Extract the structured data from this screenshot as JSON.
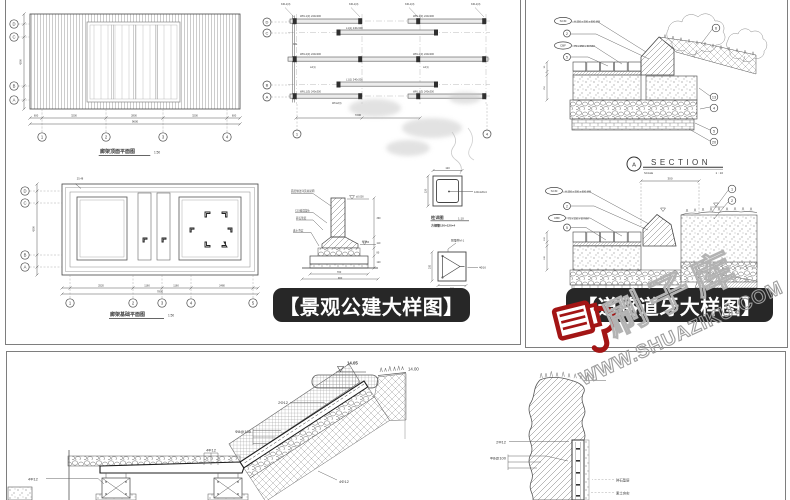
{
  "banners": {
    "landscape": "【景观公建大样图】",
    "road": "【道路道牙大样图】"
  },
  "watermark": {
    "brand": "刷子库",
    "domain": "WWW.SHUAZIKU.COM",
    "accent_color": "#a31515"
  },
  "landscape_panel": {
    "deck_plan": {
      "title": "廊架顶面平面图",
      "scale": "1:50",
      "row_bubbles": [
        {
          "x": 14,
          "y": 24,
          "t": "D"
        },
        {
          "x": 14,
          "y": 37,
          "t": "C"
        },
        {
          "x": 14,
          "y": 86,
          "t": "B"
        },
        {
          "x": 14,
          "y": 100,
          "t": "A"
        }
      ],
      "col_bubbles": [
        {
          "x": 42,
          "y": 137,
          "t": "1"
        },
        {
          "x": 106,
          "y": 137,
          "t": "2"
        },
        {
          "x": 163,
          "y": 137,
          "t": "3"
        },
        {
          "x": 227,
          "y": 137,
          "t": "4"
        }
      ],
      "dims": [
        {
          "x": 36,
          "y": 116.5,
          "t": "600",
          "s": 2.6,
          "a": "middle"
        },
        {
          "x": 74,
          "y": 116.5,
          "t": "3200",
          "s": 2.6,
          "a": "middle"
        },
        {
          "x": 134,
          "y": 116.5,
          "t": "2800",
          "s": 2.6,
          "a": "middle"
        },
        {
          "x": 195,
          "y": 116.5,
          "t": "3200",
          "s": 2.6,
          "a": "middle"
        },
        {
          "x": 234,
          "y": 116.5,
          "t": "600",
          "s": 2.6,
          "a": "middle"
        },
        {
          "x": 135,
          "y": 122.5,
          "t": "9600",
          "s": 2.8,
          "a": "middle"
        },
        {
          "x": 21.5,
          "y": 62,
          "t": "4200",
          "s": 2.6,
          "a": "middle",
          "r": -90
        }
      ]
    },
    "base_plan": {
      "title": "廊架基础平面图",
      "scale": "1:50",
      "row_bubbles": [
        {
          "x": 25,
          "y": 191,
          "t": "D"
        },
        {
          "x": 25,
          "y": 203,
          "t": "C"
        },
        {
          "x": 25,
          "y": 255,
          "t": "B"
        },
        {
          "x": 25,
          "y": 267,
          "t": "A"
        }
      ],
      "col_bubbles": [
        {
          "x": 70,
          "y": 303,
          "t": "1"
        },
        {
          "x": 133,
          "y": 303,
          "t": "2"
        },
        {
          "x": 162,
          "y": 303,
          "t": "3"
        },
        {
          "x": 191,
          "y": 303,
          "t": "4"
        },
        {
          "x": 253,
          "y": 303,
          "t": "5"
        }
      ],
      "dims": [
        {
          "x": 101,
          "y": 286.5,
          "t": "2520",
          "s": 2.6,
          "a": "middle"
        },
        {
          "x": 147,
          "y": 286.5,
          "t": "1160",
          "s": 2.6,
          "a": "middle"
        },
        {
          "x": 176,
          "y": 286.5,
          "t": "1160",
          "s": 2.6,
          "a": "middle"
        },
        {
          "x": 222,
          "y": 286.5,
          "t": "2480",
          "s": 2.6,
          "a": "middle"
        },
        {
          "x": 160,
          "y": 292.5,
          "t": "7800",
          "s": 2.8,
          "a": "middle"
        },
        {
          "x": 34.5,
          "y": 229,
          "t": "4200",
          "s": 2.6,
          "a": "middle",
          "r": -90
        },
        {
          "x": 80,
          "y": 179.5,
          "t": "25.48",
          "s": 2.6,
          "a": "middle"
        }
      ]
    },
    "framing_plan": {
      "row_bubbles": [
        {
          "x": 267,
          "y": 22,
          "t": "D",
          "r": 4
        },
        {
          "x": 267,
          "y": 33,
          "t": "C",
          "r": 4
        },
        {
          "x": 267,
          "y": 85,
          "t": "B",
          "r": 4
        },
        {
          "x": 267,
          "y": 97,
          "t": "A",
          "r": 4
        }
      ],
      "col_bubbles": [
        {
          "x": 297,
          "y": 134,
          "t": "1",
          "r": 4
        },
        {
          "x": 487,
          "y": 134,
          "t": "4",
          "r": 4
        }
      ],
      "top_labels": [
        {
          "x": 281,
          "y": 5,
          "t": "KZL1(3)",
          "s": 2.6
        },
        {
          "x": 349,
          "y": 5,
          "t": "KZL1(3)",
          "s": 2.6
        },
        {
          "x": 405,
          "y": 5,
          "t": "KZL1(3)",
          "s": 2.6
        },
        {
          "x": 471,
          "y": 5,
          "t": "KZL1(3)",
          "s": 2.6
        }
      ],
      "beam_labels": [
        {
          "x": 300,
          "y": 17,
          "t": "WKL1(3) 240x300",
          "s": 2.6
        },
        {
          "x": 413,
          "y": 17,
          "t": "WKL1(3) 240x300",
          "s": 2.6
        },
        {
          "x": 346,
          "y": 29,
          "t": "L1(1) 240x300",
          "s": 2.6
        },
        {
          "x": 293,
          "y": 45,
          "t": "KZ1",
          "s": 2.4
        },
        {
          "x": 300,
          "y": 55,
          "t": "WKL2(3) 240x300",
          "s": 2.6
        },
        {
          "x": 413,
          "y": 55,
          "t": "WKL2(3) 240x300",
          "s": 2.6
        },
        {
          "x": 310,
          "y": 68,
          "t": "L2(1)",
          "s": 2.4
        },
        {
          "x": 423,
          "y": 68,
          "t": "L2(1)",
          "s": 2.4
        },
        {
          "x": 346,
          "y": 80.5,
          "t": "L1(1) 240x300",
          "s": 2.6
        },
        {
          "x": 300,
          "y": 92.5,
          "t": "WKL1(3) 240x300",
          "s": 2.6
        },
        {
          "x": 413,
          "y": 92.5,
          "t": "WKL1(3) 240x300",
          "s": 2.6
        },
        {
          "x": 332,
          "y": 104,
          "t": "WKL2(3)",
          "s": 2.4
        }
      ],
      "dims": [
        {
          "x": 358,
          "y": 116,
          "t": "7200",
          "s": 2.8,
          "a": "middle"
        }
      ]
    },
    "footing_detail": {
      "notes": [
        {
          "x": 291,
          "y": 192,
          "t": "面层做法详见总说明",
          "s": 2.6
        },
        {
          "x": 295,
          "y": 211.5,
          "t": "C15素混凝土",
          "s": 2.6
        },
        {
          "x": 296,
          "y": 219,
          "t": "碎石垫层",
          "s": 2.6
        },
        {
          "x": 293,
          "y": 231.5,
          "t": "素土夯实",
          "s": 2.6
        }
      ],
      "dims": [
        {
          "x": 376.5,
          "y": 219,
          "t": "390",
          "s": 2.4
        },
        {
          "x": 376.5,
          "y": 244,
          "t": "110",
          "s": 2.4
        },
        {
          "x": 376.5,
          "y": 253.5,
          "t": "80",
          "s": 2.4
        },
        {
          "x": 376.5,
          "y": 263,
          "t": "120",
          "s": 2.4
        },
        {
          "x": 339,
          "y": 272.8,
          "t": "700",
          "s": 2.6,
          "a": "middle"
        },
        {
          "x": 340,
          "y": 278.8,
          "t": "900",
          "s": 2.6,
          "a": "middle"
        }
      ],
      "elevs": [
        {
          "x": 356,
          "y": 197.5,
          "t": "±0.000",
          "s": 2.5
        },
        {
          "x": 362,
          "y": 243,
          "t": "-0.450",
          "s": 2.5
        }
      ]
    },
    "tube_detail": {
      "title": "柱详图",
      "scale": "1:10",
      "subtitle": "方钢管120×120×4",
      "callout": "120x120x4",
      "dim_top": "120",
      "dim_left": "120"
    },
    "embed_detail": {
      "label_top": "预埋件M-1",
      "label_right": "4Φ16",
      "dim_left": "200",
      "dim_bottom": "280"
    }
  },
  "road_panel": {
    "section_a": {
      "callouts": [
        {
          "x": 563,
          "y": 21,
          "t": "SCM",
          "w": 8.5
        },
        {
          "x": 567,
          "y": 33.5,
          "t": "2",
          "r": 3.5
        },
        {
          "x": 563,
          "y": 45.5,
          "t": "CBF",
          "w": 8.5
        },
        {
          "x": 567,
          "y": 57,
          "t": "5",
          "r": 3.5
        }
      ],
      "notes": [
        {
          "x": 574,
          "y": 22.3,
          "t": "H 250 x 300 x 600 MM",
          "s": 2.6
        },
        {
          "x": 574,
          "y": 46.8,
          "t": "75 x 250 x 60 MM",
          "s": 2.6
        }
      ],
      "right_callouts": [
        {
          "x": 716,
          "y": 28,
          "t": "6",
          "r": 3.8
        },
        {
          "x": 714,
          "y": 97,
          "t": "13",
          "r": 3.8
        },
        {
          "x": 714,
          "y": 108,
          "t": "4",
          "r": 3.8
        },
        {
          "x": 714,
          "y": 131,
          "t": "5",
          "r": 3.8
        },
        {
          "x": 714,
          "y": 142,
          "t": "20",
          "r": 3.8
        }
      ],
      "left_dims": [
        {
          "x": 544.8,
          "y": 67,
          "t": "90",
          "s": 2.2,
          "a": "middle",
          "r": -90
        },
        {
          "x": 544.8,
          "y": 88,
          "t": "250",
          "s": 2.2,
          "a": "middle",
          "r": -90
        }
      ],
      "ref": "A",
      "title": "SECTION",
      "scale_label": "SCALE",
      "scale_value": "1 : 10"
    },
    "section_b": {
      "callouts": [
        {
          "x": 554,
          "y": 191,
          "t": "SCM",
          "w": 8.5
        },
        {
          "x": 567,
          "y": 206,
          "t": "2",
          "r": 3.5
        },
        {
          "x": 557,
          "y": 218,
          "t": "CBF",
          "w": 8.5
        },
        {
          "x": 567,
          "y": 227.5,
          "t": "5",
          "r": 3.5
        }
      ],
      "notes": [
        {
          "x": 565,
          "y": 192.3,
          "t": "H 250 x 300 x 600 MM",
          "s": 2.6
        },
        {
          "x": 568,
          "y": 219.3,
          "t": "75 x 250 x 60 MM",
          "s": 2.6
        }
      ],
      "right_callouts": [
        {
          "x": 732,
          "y": 189,
          "t": "1",
          "r": 3.8
        },
        {
          "x": 732,
          "y": 200.5,
          "t": "2",
          "r": 3.8
        }
      ],
      "left_dims": [
        {
          "x": 544.8,
          "y": 239,
          "t": "100",
          "s": 2.2,
          "a": "middle",
          "r": -90
        },
        {
          "x": 544.8,
          "y": 258,
          "t": "240",
          "s": 2.2,
          "a": "middle",
          "r": -90
        }
      ],
      "top_dim": "300"
    }
  },
  "steps_panel": {
    "elev_a": "14.05",
    "elev_b": "14.00",
    "rebar_labels": [
      {
        "x": 288,
        "y": 404,
        "t": "2Φ12",
        "s": 4,
        "a": "end"
      },
      {
        "x": 251,
        "y": 433,
        "t": "Φ8@100",
        "s": 4,
        "a": "end"
      },
      {
        "x": 211,
        "y": 451.5,
        "t": "4Φ12",
        "s": 4,
        "a": "middle"
      },
      {
        "x": 28,
        "y": 480.5,
        "t": "4Φ12",
        "s": 4
      },
      {
        "x": 339,
        "y": 483,
        "t": "4Φ12",
        "s": 4
      }
    ],
    "wall_labels": [
      {
        "x": 506,
        "y": 443.5,
        "t": "2Φ12",
        "s": 4,
        "a": "end"
      },
      {
        "x": 506,
        "y": 459.5,
        "t": "Φ8@100",
        "s": 4,
        "a": "end"
      },
      {
        "x": 616,
        "y": 481.5,
        "t": "碎石垫层",
        "s": 3.4
      },
      {
        "x": 616,
        "y": 494.5,
        "t": "素土夯实",
        "s": 3.4
      }
    ]
  }
}
